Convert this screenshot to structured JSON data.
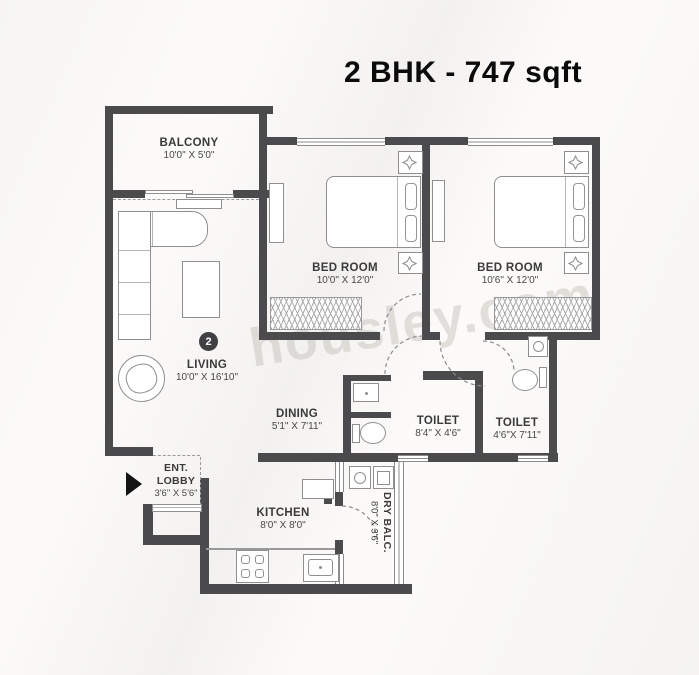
{
  "title": "2 BHK - 747 sqft",
  "watermark": "housley.com",
  "unit_badge": "2",
  "rooms": {
    "balcony": {
      "name": "BALCONY",
      "dims": "10'0\" X 5'0\""
    },
    "bedroom_1": {
      "name": "BED ROOM",
      "dims": "10'0\" X 12'0\""
    },
    "bedroom_2": {
      "name": "BED ROOM",
      "dims": "10'6\" X 12'0\""
    },
    "living": {
      "name": "LIVING",
      "dims": "10'0\" X 16'10\""
    },
    "dining": {
      "name": "DINING",
      "dims": "5'1\" X 7'11\""
    },
    "toilet_1": {
      "name": "TOILET",
      "dims": "8'4\" X 4'6\""
    },
    "toilet_2": {
      "name": "TOILET",
      "dims": "4'6\"X 7'11\""
    },
    "ent_lobby": {
      "name_line_1": "ENT.",
      "name_line_2": "LOBBY",
      "dims": "3'6\" X 5'6\""
    },
    "kitchen": {
      "name": "KITCHEN",
      "dims": "8'0\" X 8'0\""
    },
    "dry_balcony": {
      "name": "DRY BALC.",
      "dims": "8'0\" X 3'6\""
    }
  },
  "icons": {
    "entry_arrow": "right-pointing solid triangle",
    "decor": "eight-point star on bedside tables"
  },
  "colors": {
    "wall": "#4b4b4d",
    "furniture_line": "#8f8f8f",
    "label_text": "#3a3a3a",
    "title_text": "#0b0b0b",
    "watermark_text": "#b8b2aa",
    "badge_bg": "#404042"
  }
}
